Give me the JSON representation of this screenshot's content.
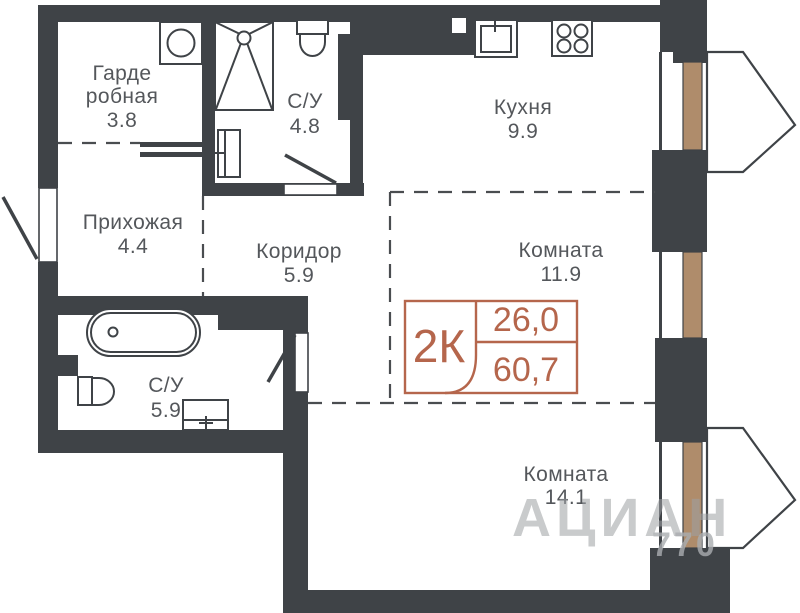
{
  "colors": {
    "wall": "#3f4347",
    "window_glass": "#af8c6b",
    "badge_accent": "#b5664c",
    "label_gray": "#54575b"
  },
  "rooms": {
    "wardrobe": {
      "name_line1": "Гарде",
      "name_line2": "робная",
      "area": "3.8"
    },
    "bath_top": {
      "name": "С/У",
      "area": "4.8"
    },
    "kitchen": {
      "name": "Кухня",
      "area": "9.9"
    },
    "hallway": {
      "name": "Прихожая",
      "area": "4.4"
    },
    "corridor": {
      "name": "Коридор",
      "area": "5.9"
    },
    "room_mid": {
      "name": "Комната",
      "area": "11.9"
    },
    "bath_bottom": {
      "name": "С/У",
      "area": "5.9"
    },
    "room_bottom": {
      "name": "Комната",
      "area": "14.1"
    }
  },
  "badge": {
    "type": "2К",
    "living_area": "26,0",
    "total_area": "60,7"
  },
  "watermark": {
    "text": "АЦИАН",
    "number": "770"
  }
}
